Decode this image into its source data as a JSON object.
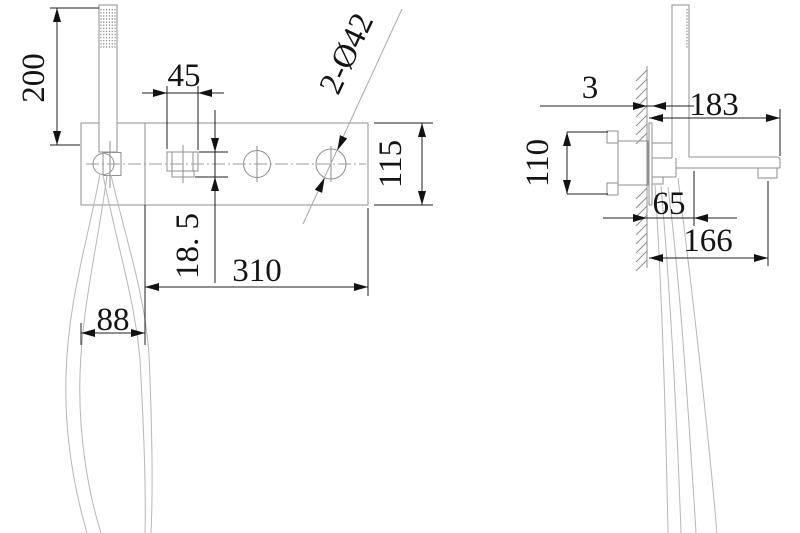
{
  "drawing": {
    "description": "wall-mounted bath shower mixer installation drawing, front and side views",
    "front_view": {
      "dim_handshower_height": "200",
      "dim_spout_width": "45",
      "dim_holes": "2-Ø42",
      "dim_plate_height": "115",
      "dim_spout_drop": "18. 5",
      "dim_plate_width": "310",
      "dim_shower_module_width": "88"
    },
    "side_view": {
      "dim_plate_thickness": "3",
      "dim_total_reach": "183",
      "dim_valve_height": "110",
      "dim_hose_offset": "65",
      "dim_spout_reach": "166"
    },
    "colors": {
      "part_line": "#8f8f8f",
      "dimension_line": "#1f1f1f",
      "background": "#ffffff"
    }
  }
}
